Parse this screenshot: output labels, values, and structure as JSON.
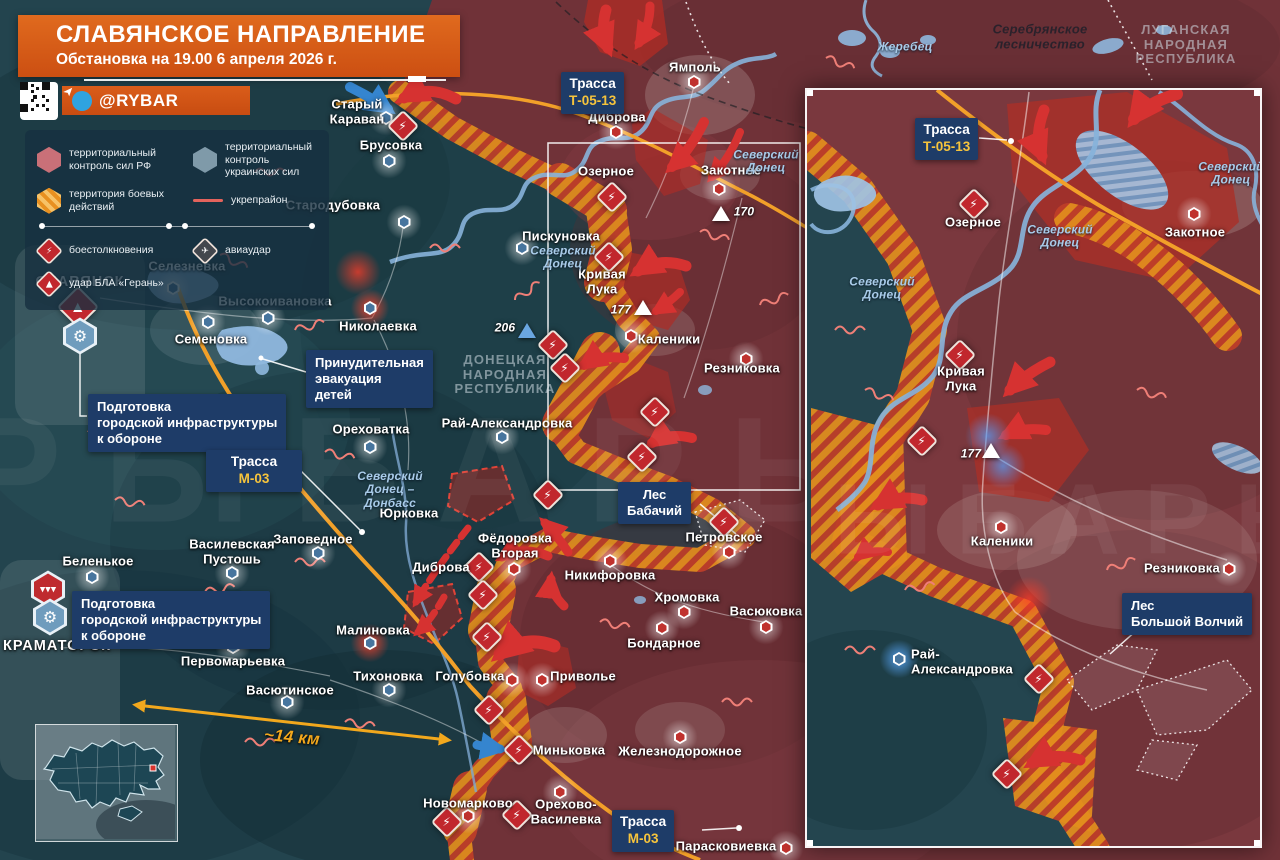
{
  "header": {
    "title": "СЛАВЯНСКОЕ НАПРАВЛЕНИЕ",
    "subtitle": "Обстановка на 19.00 6 апреля 2026 г.",
    "channel": "@RYBAR"
  },
  "watermark": "РЫБАРЬ",
  "legend": {
    "rf": "территориальный контроль сил РФ",
    "ua": "территориальный контроль украинских сил",
    "combat": "территория боевых действий",
    "fort": "укрепрайон",
    "clash": "боестолкновения",
    "air": "авиаудар",
    "drone": "удар БЛА «Герань»"
  },
  "roads": {
    "label": "Трасса",
    "m03": "М-03",
    "t0513": "Т-05-13"
  },
  "distance": "~14 км",
  "heights": {
    "h206": "206",
    "h170": "170",
    "h177": "177"
  },
  "regions": {
    "dnr": "ДОНЕЦКАЯ\nНАРОДНАЯ\nРЕСПУБЛИКА",
    "lnr": "ЛУГАНСКАЯ\nНАРОДНАЯ\nРЕСПУБЛИКА",
    "forest": "Серебрянское\nлесничество"
  },
  "callouts": {
    "evac": "Принудительная\nэвакуация\nдетей",
    "prep": "Подготовка\nгородской инфраструктуры\nк обороне",
    "les_bab": "Лес\nБабачий",
    "les_vol": "Лес\nБольшой Волчий"
  },
  "main_towns": [
    "СЛАВЯНСК",
    "КРАМАТОРСК",
    "Старый\nКараван",
    "Брусовка",
    "Стародубовка",
    "Пискуновка",
    "Селезневка",
    "Высокоивановка",
    "Семеновка",
    "Николаевка",
    "Ореховатка",
    "Юрковка",
    "Заповедное",
    "Василевская\nПустошь",
    "Беленькое",
    "Первомарьевка",
    "Васютинское",
    "Малиновка",
    "Тихоновка",
    "Голубовка",
    "Рай-Александровка",
    "Фёдоровка\nВторая",
    "Диброва",
    "Новомарково",
    "Ямполь",
    "Диброва",
    "Озерное",
    "Закотное",
    "Кривая\nЛука",
    "Каленики",
    "Резниковка",
    "Никифоровка",
    "Хромовка",
    "Васюковка",
    "Бондарное",
    "Приволье",
    "Миньковка",
    "Железнодорожное",
    "Орехово-\nВасилевка",
    "Парасковиевка",
    "Петровское"
  ],
  "main_rivers": [
    "Северский\nДонец",
    "Северский\nДонец",
    "Жеребец",
    "Северский\nДонец –\nДонбасс"
  ],
  "inset_towns": [
    "Озерное",
    "Закотное",
    "Кривая\nЛука",
    "Каленики",
    "Резниковка",
    "Рай-\nАлександровка"
  ],
  "inset_rivers": [
    "Северский\nДонец",
    "Северский\nДонец",
    "Северский\nДонец"
  ]
}
